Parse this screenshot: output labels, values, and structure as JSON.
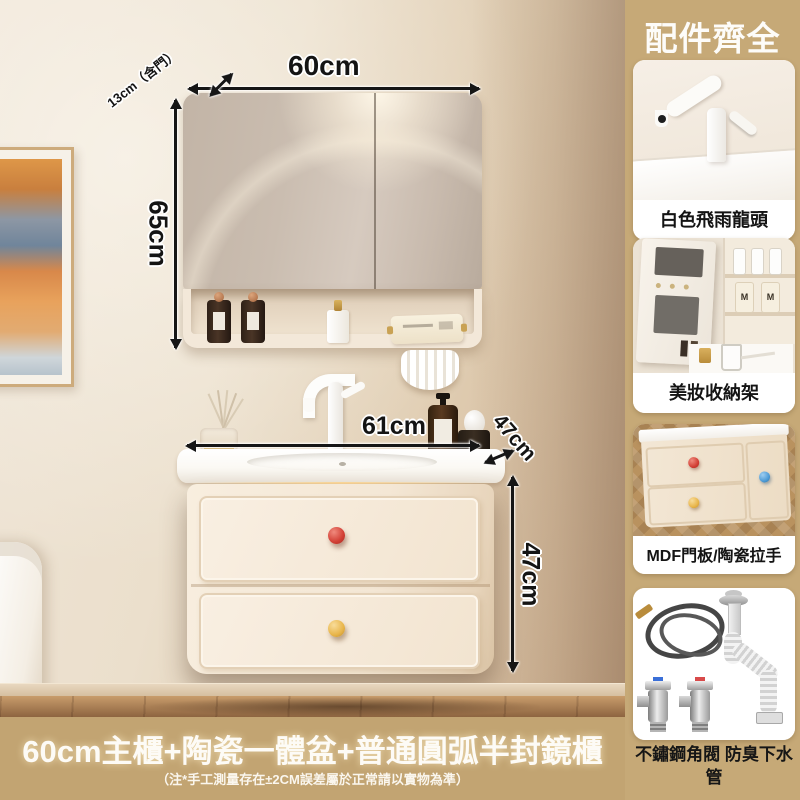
{
  "header": {
    "title": "配件齊全"
  },
  "accessories": [
    {
      "label": "白色飛雨龍頭"
    },
    {
      "label": "美妝收納架"
    },
    {
      "label": "MDF門板/陶瓷拉手"
    },
    {
      "label": "不鏽鋼角閥 防臭下水管"
    }
  ],
  "accessory_details": {
    "bottle_monogram": "M"
  },
  "dimensions": {
    "mirror_width": "60cm",
    "mirror_depth": "13cm（含門）",
    "mirror_height": "65cm",
    "vanity_width": "61cm",
    "vanity_depth": "47cm",
    "vanity_height": "47cm"
  },
  "banner": {
    "title": "60cm主櫃+陶瓷一體盆+普通圓弧半封鏡櫃",
    "note": "（注*手工測量存在±2CM誤差屬於正常請以實物為準）"
  },
  "colors": {
    "accent_tan": "#c6a977",
    "knob_red": "#d23f35",
    "knob_yellow": "#e8b54a",
    "knob_blue": "#4d9bd6",
    "dimension_text": "#141414",
    "banner_text": "#fdfbf6"
  }
}
